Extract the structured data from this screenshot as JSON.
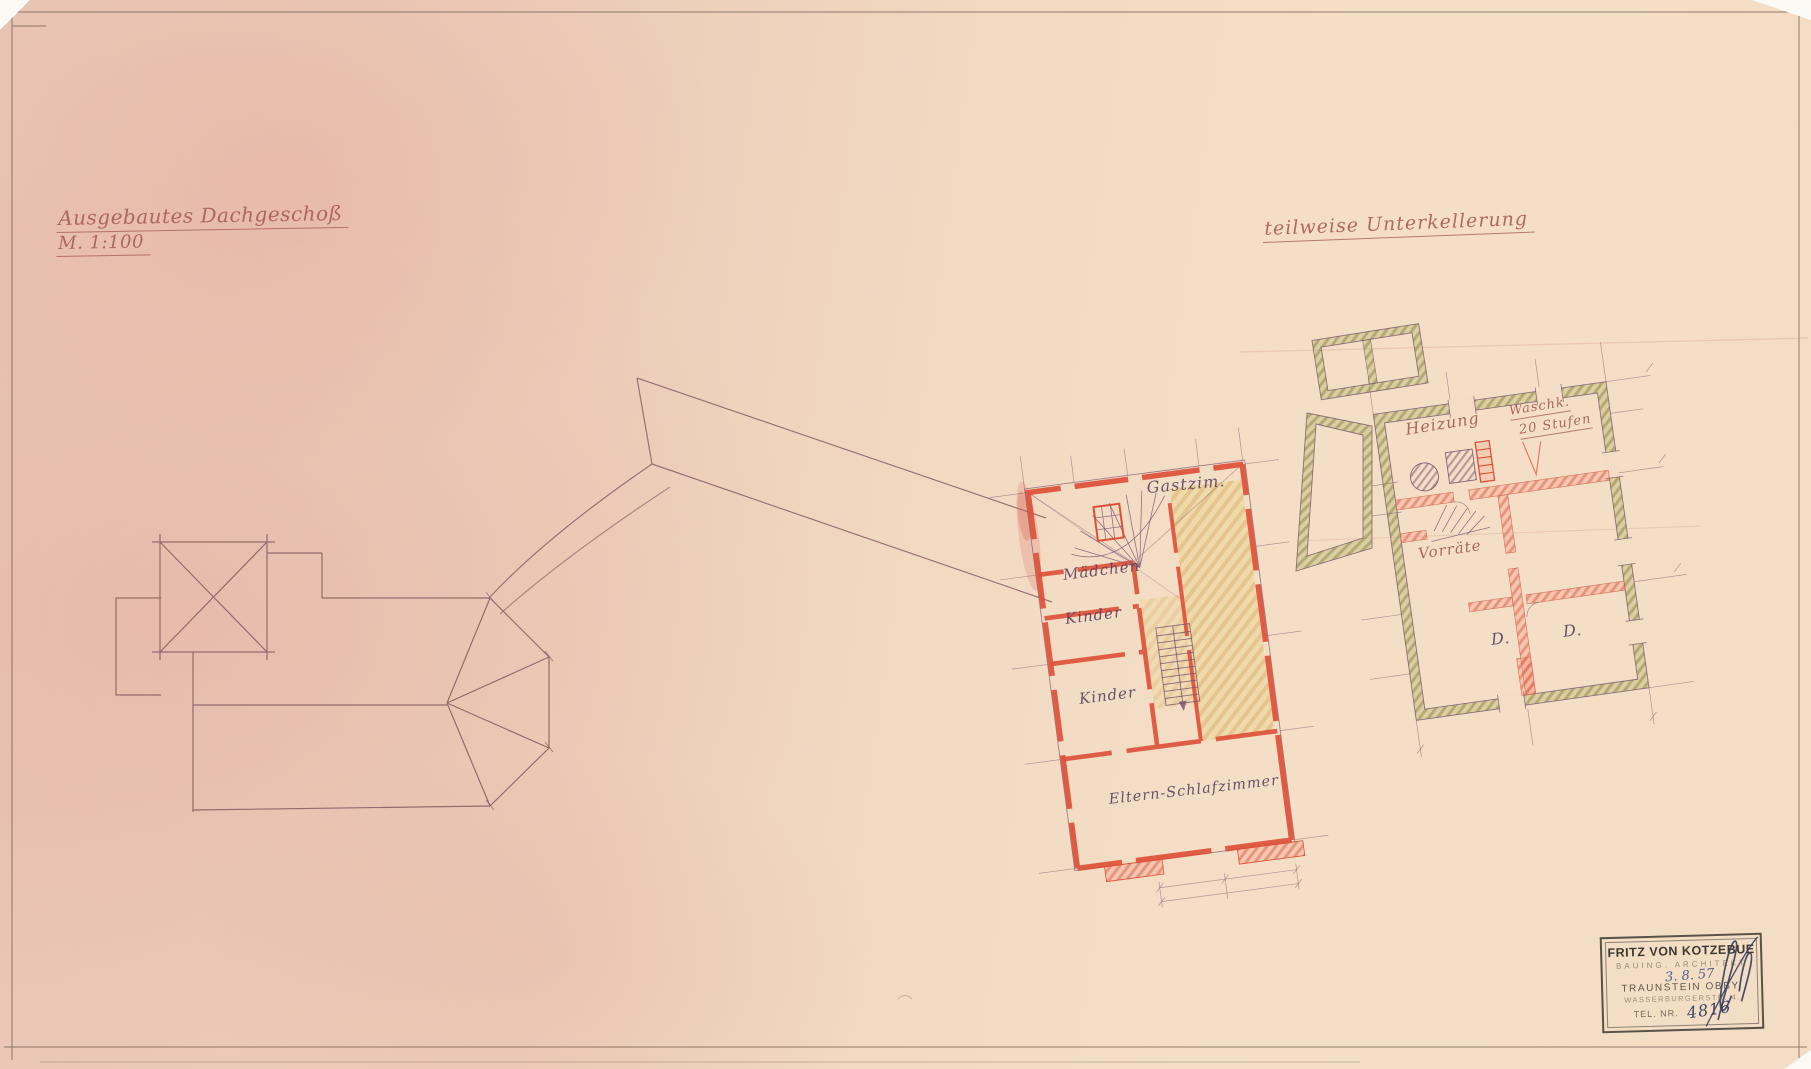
{
  "titles": {
    "attic": {
      "line1": "Ausgebautes Dachgeschoß",
      "line2": "M. 1:100"
    },
    "basement": {
      "line1": "teilweise Unterkellerung"
    }
  },
  "attic_plan": {
    "rooms": [
      "Gastzim.",
      "Mädchen",
      "Kinder",
      "Kinder",
      "Eltern-Schlafzimmer"
    ]
  },
  "basement_plan": {
    "rooms": [
      "Heizung",
      "Waschk.",
      "20 Stufen",
      "Vorräte",
      "D.",
      "D."
    ]
  },
  "stamp": {
    "name": "FRITZ VON KOTZEBUE",
    "profession": "BAUING. ARCHITEKT",
    "date_handwritten": "3. 8. 57",
    "city": "TRAUNSTEIN OBBY.",
    "street": "WASSERBURGERSTR. 4.",
    "phone_label": "TEL. NR.",
    "phone_handwritten": "4816"
  },
  "colors": {
    "paper_pink": "#eac6b5",
    "paper_cream": "#f4dfc6",
    "title_ink": "#a85e5c",
    "plan_line_ink": "#8b6168",
    "label_ink": "#583e5c",
    "wall_red": "#de5038",
    "wall_green_hatch": "#b4ae6e",
    "corridor_yellow": "#eed9a4",
    "stamp_ink": "#3f3b38",
    "handwriting_blue": "#53628c"
  }
}
